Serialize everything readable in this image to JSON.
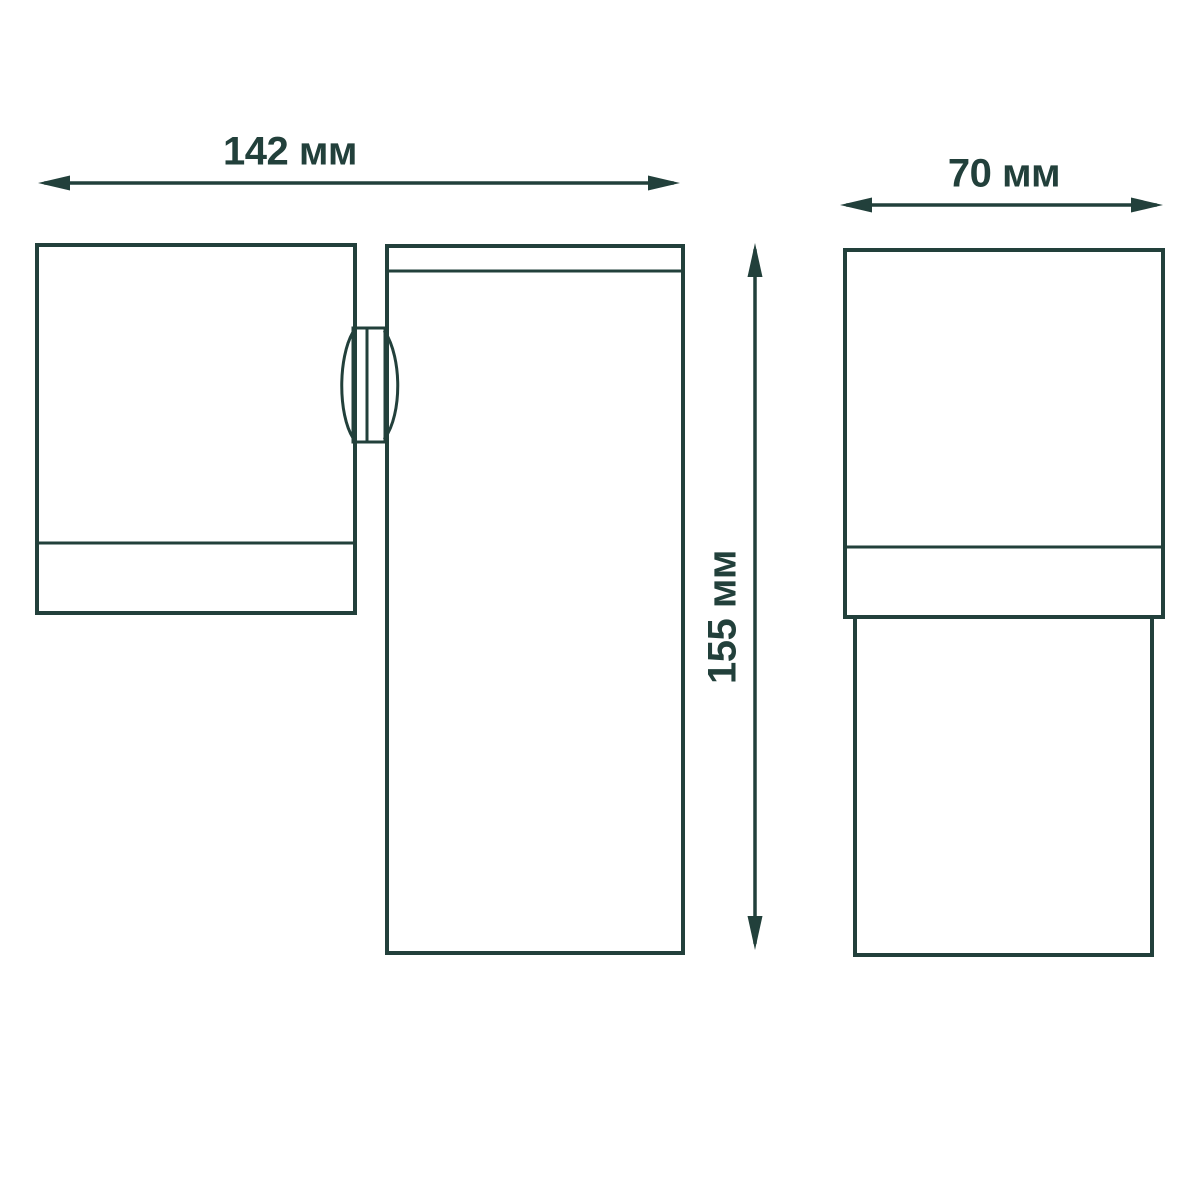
{
  "dimensions": {
    "width_label": "142 мм",
    "depth_label": "70 мм",
    "height_label": "155 мм"
  },
  "colors": {
    "ink": "#22403B",
    "background": "#FFFFFF"
  }
}
